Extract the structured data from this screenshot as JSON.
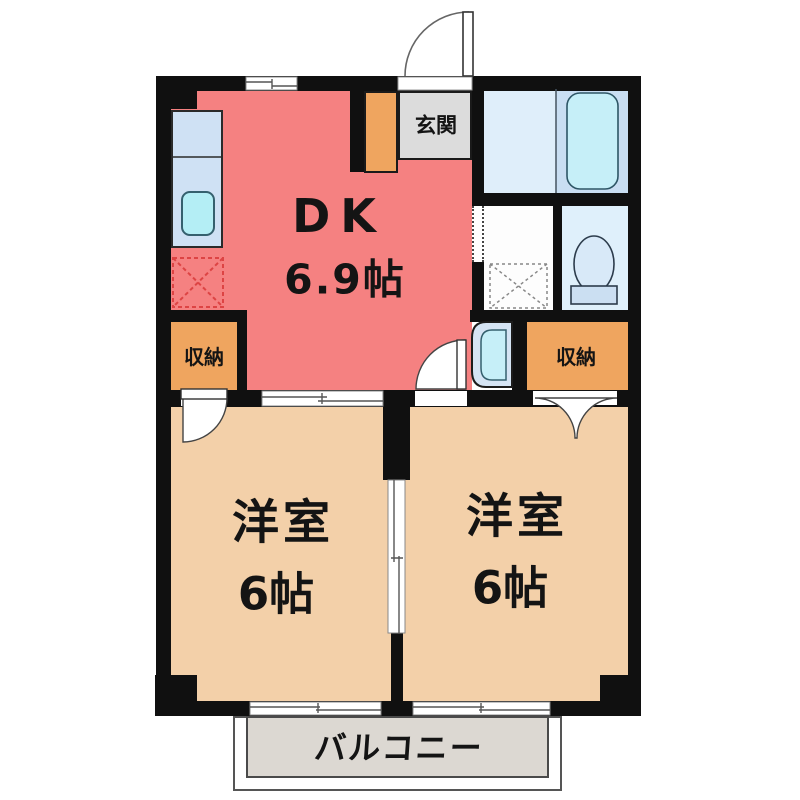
{
  "floorplan": {
    "rooms": {
      "dk": {
        "name": "DK",
        "size": "6.9帖"
      },
      "genkan": {
        "label": "玄関"
      },
      "storage_left": {
        "label": "収納"
      },
      "storage_right": {
        "label": "収納"
      },
      "western_left": {
        "name": "洋室",
        "size": "6帖"
      },
      "western_right": {
        "name": "洋室",
        "size": "6帖"
      },
      "balcony": {
        "label": "バルコニー"
      }
    },
    "fixtures": [
      "entrance-door",
      "kitchen-counter",
      "sink",
      "refrigerator-space",
      "bathtub",
      "washing-machine-pan",
      "toilet",
      "washbasin",
      "sliding-doors",
      "windows"
    ],
    "colors": {
      "dk": "#f58181",
      "western_room": "#f3d0a9",
      "storage": "#efa55f",
      "genkan": "#dcdcdc",
      "balcony": "#dcd8d2",
      "wall": "#101010",
      "bath_floor_left": "#dfeefa",
      "bath_floor_right": "#c9def2",
      "bathtub": "#c6eff8",
      "toilet_room": "#dff0fb",
      "kitchen_counter": "#cfe1f4",
      "sink": "#b4eef5",
      "refrigerator_dash": "#dd4444"
    }
  }
}
